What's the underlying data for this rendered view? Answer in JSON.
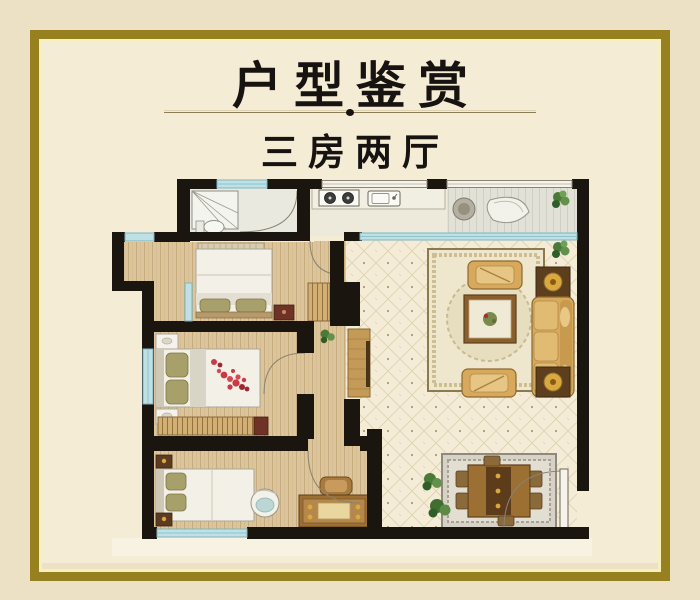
{
  "theme": {
    "bg-outer": "#ece1c4",
    "bg-inner": "#f5ecd6",
    "gold": "#97801f",
    "gold-light": "#f6efbe",
    "ink": "#171310",
    "wall": "#1b1510",
    "window": "#bfe0e4",
    "wood": "#dcc59c",
    "tile": "#f4ecd7",
    "sofa": "#d8a85c",
    "accent-red": "#c93a45"
  },
  "header": {
    "title": "户型鉴赏",
    "subtitle": "三房两厅"
  },
  "floorplan": {
    "type": "apartment-floor-plan",
    "layout": "3 bedrooms, living room, dining room, kitchen, bathroom, balcony",
    "rooms": [
      "bathroom",
      "kitchen",
      "balcony",
      "bedroom-2",
      "master-bedroom",
      "bedroom-3",
      "living-room",
      "dining-area",
      "hallway"
    ],
    "furniture": [
      "shower",
      "toilet",
      "kitchen-counter",
      "stove",
      "kitchen-sink",
      "wash-basin",
      "bowl",
      "double-bed",
      "master-bed-with-petals",
      "single-bed",
      "wardrobe",
      "nightstand",
      "air-conditioner",
      "sofa",
      "armchair",
      "coffee-table",
      "side-table-with-lamp",
      "tv-cabinet",
      "living-rug",
      "dining-rug",
      "dining-table",
      "dining-chair",
      "desk",
      "desk-chair",
      "round-chair",
      "plant",
      "entrance-door"
    ]
  }
}
